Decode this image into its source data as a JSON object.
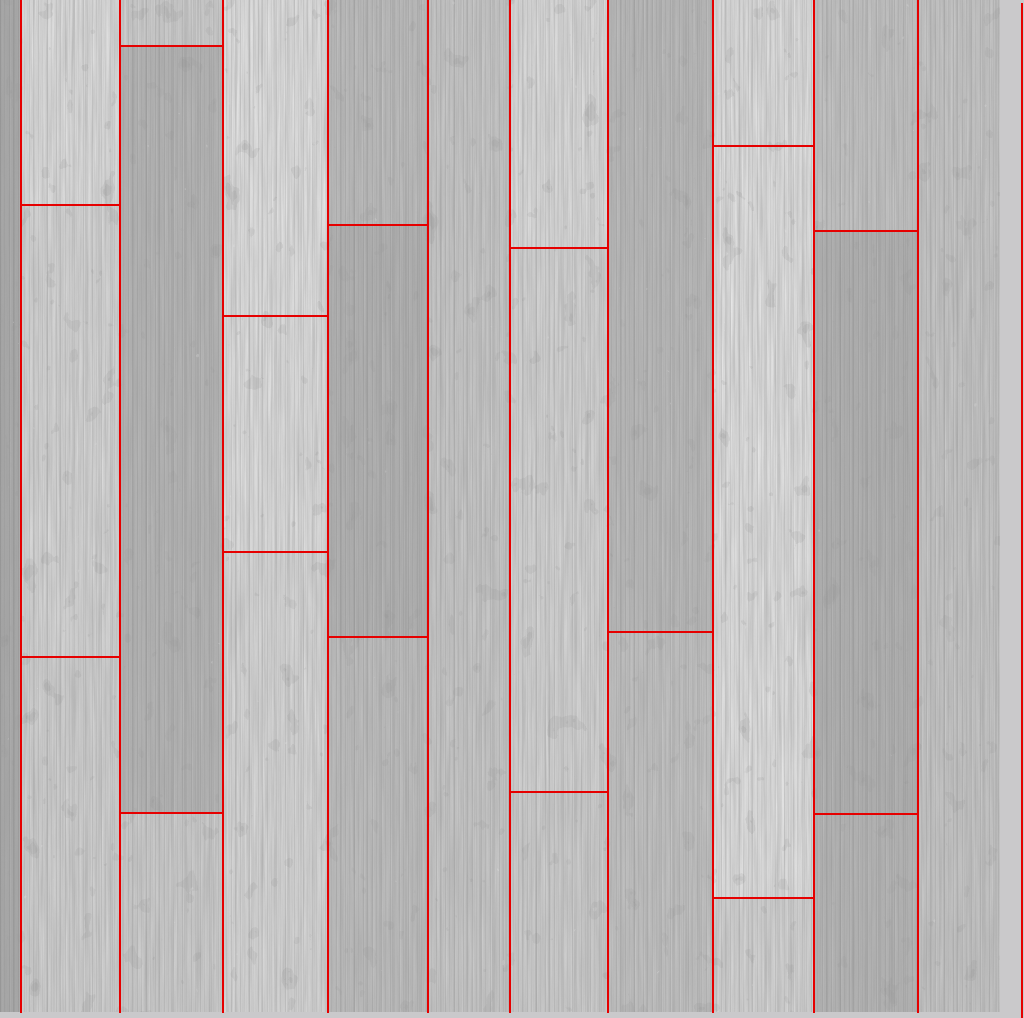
{
  "scene": {
    "description": "Whitewashed grey wooden plank floor texture photographed top-down, annotated with thin red rectangles outlining each plank",
    "canvas": {
      "width": 1024,
      "height": 1018
    },
    "texture": {
      "width": 1000,
      "height": 1012
    },
    "colors": {
      "annotation_red": "#e60000",
      "margin_gray": "#cac9cb",
      "background": "#cbcbcb"
    }
  },
  "planks": {
    "grain_direction": "vertical",
    "columns": [
      {
        "x": 0,
        "width": 20,
        "segments": [
          {
            "y": 0,
            "h": 1012,
            "color": "#a9a9a9"
          }
        ]
      },
      {
        "x": 20,
        "width": 99,
        "segments": [
          {
            "y": 0,
            "h": 204,
            "color": "#e0e0e0"
          },
          {
            "y": 204,
            "h": 452,
            "color": "#d7d7d7"
          },
          {
            "y": 656,
            "h": 356,
            "color": "#d2d2d2"
          }
        ]
      },
      {
        "x": 119,
        "width": 103,
        "segments": [
          {
            "y": 0,
            "h": 45,
            "color": "#cfcfcf"
          },
          {
            "y": 45,
            "h": 767,
            "color": "#b4b4b4"
          },
          {
            "y": 812,
            "h": 200,
            "color": "#cecece"
          }
        ]
      },
      {
        "x": 222,
        "width": 105,
        "segments": [
          {
            "y": 0,
            "h": 315,
            "color": "#e3e3e3"
          },
          {
            "y": 315,
            "h": 236,
            "color": "#e0e0e0"
          },
          {
            "y": 551,
            "h": 461,
            "color": "#d9d9d9"
          }
        ]
      },
      {
        "x": 327,
        "width": 100,
        "segments": [
          {
            "y": 0,
            "h": 224,
            "color": "#bcbcbc"
          },
          {
            "y": 224,
            "h": 412,
            "color": "#b1b1b1"
          },
          {
            "y": 636,
            "h": 376,
            "color": "#bebebe"
          }
        ]
      },
      {
        "x": 427,
        "width": 82,
        "segments": [
          {
            "y": 0,
            "h": 1012,
            "color": "#c8c8c8"
          }
        ]
      },
      {
        "x": 509,
        "width": 98,
        "segments": [
          {
            "y": 0,
            "h": 247,
            "color": "#dedede"
          },
          {
            "y": 247,
            "h": 544,
            "color": "#d5d5d5"
          },
          {
            "y": 791,
            "h": 221,
            "color": "#cecece"
          }
        ]
      },
      {
        "x": 607,
        "width": 105,
        "segments": [
          {
            "y": 0,
            "h": 631,
            "color": "#b9b9b9"
          },
          {
            "y": 631,
            "h": 381,
            "color": "#c2c2c2"
          }
        ]
      },
      {
        "x": 712,
        "width": 101,
        "segments": [
          {
            "y": 0,
            "h": 145,
            "color": "#e0e0e0"
          },
          {
            "y": 145,
            "h": 752,
            "color": "#e3e3e3"
          },
          {
            "y": 897,
            "h": 115,
            "color": "#d5d5d5"
          }
        ]
      },
      {
        "x": 813,
        "width": 104,
        "segments": [
          {
            "y": 0,
            "h": 230,
            "color": "#c3c3c3"
          },
          {
            "y": 230,
            "h": 583,
            "color": "#b0b0b0"
          },
          {
            "y": 813,
            "h": 199,
            "color": "#b5b5b5"
          }
        ]
      },
      {
        "x": 917,
        "width": 83,
        "segments": [
          {
            "y": 0,
            "h": 1012,
            "color": "#c6c6c6"
          }
        ]
      }
    ]
  },
  "annotation_lines": {
    "vertical": [
      {
        "x": 20,
        "y": 0,
        "h": 1013
      },
      {
        "x": 119,
        "y": 0,
        "h": 1013
      },
      {
        "x": 222,
        "y": 0,
        "h": 1013
      },
      {
        "x": 327,
        "y": 0,
        "h": 1013
      },
      {
        "x": 427,
        "y": 0,
        "h": 1013
      },
      {
        "x": 509,
        "y": 0,
        "h": 1013
      },
      {
        "x": 607,
        "y": 0,
        "h": 1013
      },
      {
        "x": 712,
        "y": 0,
        "h": 1013
      },
      {
        "x": 813,
        "y": 0,
        "h": 1013
      },
      {
        "x": 917,
        "y": 0,
        "h": 1013
      },
      {
        "x": 1021,
        "y": 3,
        "h": 1015
      }
    ],
    "horizontal_seams": [
      {
        "x": 20,
        "width": 99,
        "y": 204
      },
      {
        "x": 20,
        "width": 99,
        "y": 656
      },
      {
        "x": 119,
        "width": 103,
        "y": 45
      },
      {
        "x": 119,
        "width": 103,
        "y": 812
      },
      {
        "x": 222,
        "width": 105,
        "y": 315
      },
      {
        "x": 222,
        "width": 105,
        "y": 551
      },
      {
        "x": 327,
        "width": 100,
        "y": 224
      },
      {
        "x": 327,
        "width": 100,
        "y": 636
      },
      {
        "x": 509,
        "width": 98,
        "y": 247
      },
      {
        "x": 509,
        "width": 98,
        "y": 791
      },
      {
        "x": 607,
        "width": 105,
        "y": 631
      },
      {
        "x": 712,
        "width": 101,
        "y": 145
      },
      {
        "x": 712,
        "width": 101,
        "y": 897
      },
      {
        "x": 813,
        "width": 104,
        "y": 230
      },
      {
        "x": 813,
        "width": 104,
        "y": 813
      }
    ]
  }
}
